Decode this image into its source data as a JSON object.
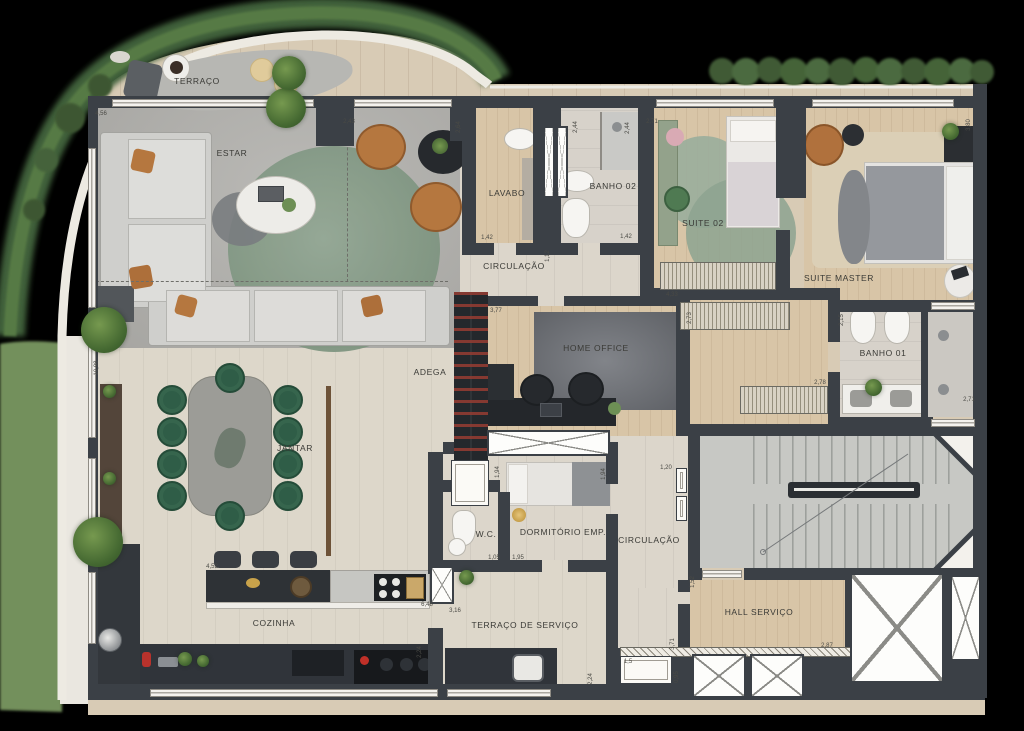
{
  "plan": {
    "title": "apartment-floor-plan",
    "rooms": [
      {
        "label": "TERRAÇO"
      },
      {
        "label": "ESTAR"
      },
      {
        "label": "LAVABO"
      },
      {
        "label": "BANHO 02"
      },
      {
        "label": "SUITE 02"
      },
      {
        "label": "SUITE MASTER"
      },
      {
        "label": "CIRCULAÇÃO"
      },
      {
        "label": "ADEGA"
      },
      {
        "label": "HOME OFFICE"
      },
      {
        "label": "BANHO 01"
      },
      {
        "label": "JANTAR"
      },
      {
        "label": "W.C."
      },
      {
        "label": "DORMITÓRIO EMP."
      },
      {
        "label": "CIRCULAÇÃO"
      },
      {
        "label": "HALL SERVIÇO"
      },
      {
        "label": "COZINHA"
      },
      {
        "label": "TERRAÇO DE SERVIÇO"
      }
    ],
    "dimensions": [
      {
        "t": "4,56",
        "x": 101,
        "y": 114,
        "r": 0
      },
      {
        "t": "2,43",
        "x": 349,
        "y": 122,
        "r": 0
      },
      {
        "t": "2,64",
        "x": 459,
        "y": 127,
        "r": 1
      },
      {
        "t": "2,44",
        "x": 576,
        "y": 127,
        "r": 1
      },
      {
        "t": "2,71",
        "x": 652,
        "y": 122,
        "r": 0
      },
      {
        "t": "2,44",
        "x": 628,
        "y": 128,
        "r": 1
      },
      {
        "t": "1,42",
        "x": 487,
        "y": 238,
        "r": 0
      },
      {
        "t": "1,42",
        "x": 626,
        "y": 237,
        "r": 0
      },
      {
        "t": "1,12",
        "x": 548,
        "y": 256,
        "r": 1
      },
      {
        "t": "4,33",
        "x": 672,
        "y": 295,
        "r": 0
      },
      {
        "t": "3,77",
        "x": 496,
        "y": 311,
        "r": 0
      },
      {
        "t": "2,73",
        "x": 690,
        "y": 318,
        "r": 1
      },
      {
        "t": "3,80",
        "x": 969,
        "y": 125,
        "r": 1
      },
      {
        "t": "2,15",
        "x": 842,
        "y": 320,
        "r": 1
      },
      {
        "t": "2,78",
        "x": 820,
        "y": 383,
        "r": 0
      },
      {
        "t": "2,71",
        "x": 969,
        "y": 400,
        "r": 0
      },
      {
        "t": "10,98",
        "x": 97,
        "y": 368,
        "r": 1
      },
      {
        "t": "4,52",
        "x": 212,
        "y": 567,
        "r": 0
      },
      {
        "t": "6,48",
        "x": 427,
        "y": 605,
        "r": 0
      },
      {
        "t": "3,16",
        "x": 455,
        "y": 611,
        "r": 0
      },
      {
        "t": "2,24",
        "x": 420,
        "y": 652,
        "r": 1
      },
      {
        "t": "2,24",
        "x": 591,
        "y": 679,
        "r": 1
      },
      {
        "t": "1,05",
        "x": 494,
        "y": 558,
        "r": 0
      },
      {
        "t": "1,95",
        "x": 518,
        "y": 558,
        "r": 0
      },
      {
        "t": "1,94",
        "x": 498,
        "y": 472,
        "r": 1
      },
      {
        "t": "1,94",
        "x": 604,
        "y": 474,
        "r": 1
      },
      {
        "t": "1,20",
        "x": 666,
        "y": 468,
        "r": 0
      },
      {
        "t": "1,52",
        "x": 693,
        "y": 582,
        "r": 1
      },
      {
        "t": "3,71",
        "x": 673,
        "y": 644,
        "r": 1
      },
      {
        "t": "2,87",
        "x": 827,
        "y": 646,
        "r": 0
      },
      {
        "t": "0,95",
        "x": 677,
        "y": 677,
        "r": 1
      },
      {
        "t": "1,5",
        "x": 628,
        "y": 662,
        "r": 0
      }
    ],
    "colors": {
      "wall": "#3b4046",
      "wood": "#d8c5a7",
      "concrete": "#b2b1ad",
      "hedge_dark": "#41603a",
      "hedge_light": "#a7bb58",
      "grass": "#73905c",
      "rug_green": "#8ba08c",
      "chair_green": "#2f5d47",
      "leather": "#b5773f",
      "counter_dark": "#30343a",
      "background": "#000000"
    }
  }
}
